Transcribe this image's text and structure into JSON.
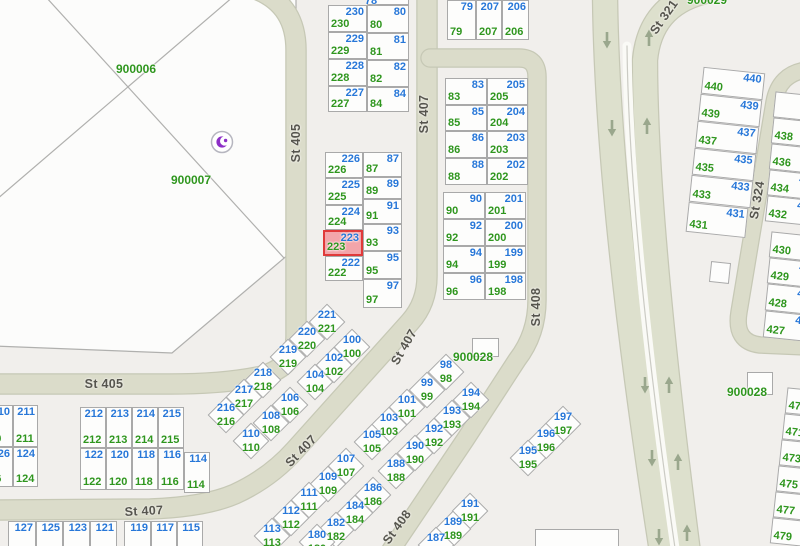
{
  "colors": {
    "background": "#f1efec",
    "parcel_fill": "#fdfdfc",
    "parcel_border": "#a9a9a9",
    "road_fill": "#dbdcca",
    "road_edge": "#c6c8b5",
    "arrow": "#9aa78d",
    "label_green": "#2f961e",
    "label_blue": "#2777d8",
    "highlight_fill": "#f3a5aa",
    "highlight_border": "#e03a3a",
    "street_label": "#56554e",
    "mosque_purple": "#8d2fc7"
  },
  "icons": {
    "mosque_icon": "crescent-and-star",
    "road_arrow_icon": "one-way-direction-arrow"
  },
  "selected_parcel": {
    "green_number": "223",
    "blue_number": "223"
  },
  "street_labels": [
    {
      "text": "St 405"
    },
    {
      "text": "St 405"
    },
    {
      "text": "St 407"
    },
    {
      "text": "St 407"
    },
    {
      "text": "St 407"
    },
    {
      "text": "St 407"
    },
    {
      "text": "St 408"
    },
    {
      "text": "St 408"
    },
    {
      "text": "St 321"
    },
    {
      "text": "St 324"
    }
  ],
  "area_labels": [
    {
      "text": "900006"
    },
    {
      "text": "900007"
    },
    {
      "text": "900028"
    },
    {
      "text": "900028"
    },
    {
      "text": "900029"
    }
  ],
  "stray_labels": [
    {
      "text": "78"
    }
  ],
  "cells": [
    {
      "x": 328,
      "y": 5,
      "w": 39,
      "h": 27,
      "g": "230",
      "b": "230"
    },
    {
      "x": 328,
      "y": 32,
      "w": 39,
      "h": 27,
      "g": "229",
      "b": "229"
    },
    {
      "x": 328,
      "y": 59,
      "w": 39,
      "h": 27,
      "g": "228",
      "b": "228"
    },
    {
      "x": 328,
      "y": 86,
      "w": 39,
      "h": 26,
      "g": "227",
      "b": "227"
    },
    {
      "x": 367,
      "y": -20,
      "w": 42,
      "h": 25
    },
    {
      "x": 367,
      "y": 5,
      "w": 42,
      "h": 28,
      "g": "80",
      "b": "80"
    },
    {
      "x": 367,
      "y": 33,
      "w": 42,
      "h": 27,
      "g": "81",
      "b": "81"
    },
    {
      "x": 367,
      "y": 60,
      "w": 42,
      "h": 27,
      "g": "82",
      "b": "82"
    },
    {
      "x": 367,
      "y": 87,
      "w": 42,
      "h": 25,
      "g": "84",
      "b": "84"
    },
    {
      "x": 447,
      "y": 0,
      "w": 29,
      "h": 40,
      "g": "79",
      "b": "79"
    },
    {
      "x": 476,
      "y": 0,
      "w": 26,
      "h": 40,
      "g": "207",
      "b": "207"
    },
    {
      "x": 502,
      "y": 0,
      "w": 27,
      "h": 40,
      "g": "206",
      "b": "206"
    },
    {
      "x": 325,
      "y": 152,
      "w": 38,
      "h": 26,
      "g": "226",
      "b": "226"
    },
    {
      "x": 325,
      "y": 178,
      "w": 38,
      "h": 27,
      "g": "225",
      "b": "225"
    },
    {
      "x": 325,
      "y": 205,
      "w": 38,
      "h": 25,
      "g": "224",
      "b": "224"
    },
    {
      "x": 323,
      "y": 230,
      "w": 40,
      "h": 26,
      "g": "223",
      "b": "223",
      "hl": 1
    },
    {
      "x": 325,
      "y": 256,
      "w": 38,
      "h": 25,
      "g": "222",
      "b": "222"
    },
    {
      "x": 363,
      "y": 152,
      "w": 39,
      "h": 25,
      "g": "87",
      "b": "87"
    },
    {
      "x": 363,
      "y": 177,
      "w": 39,
      "h": 22,
      "g": "89",
      "b": "89"
    },
    {
      "x": 363,
      "y": 199,
      "w": 39,
      "h": 25,
      "g": "91",
      "b": "91"
    },
    {
      "x": 363,
      "y": 224,
      "w": 39,
      "h": 27,
      "g": "93",
      "b": "93"
    },
    {
      "x": 363,
      "y": 251,
      "w": 39,
      "h": 28,
      "g": "95",
      "b": "95"
    },
    {
      "x": 363,
      "y": 279,
      "w": 39,
      "h": 29,
      "g": "97",
      "b": "97"
    },
    {
      "x": 445,
      "y": 78,
      "w": 42,
      "h": 27,
      "g": "83",
      "b": "83"
    },
    {
      "x": 445,
      "y": 105,
      "w": 42,
      "h": 26,
      "g": "85",
      "b": "85"
    },
    {
      "x": 445,
      "y": 131,
      "w": 42,
      "h": 27,
      "g": "86",
      "b": "86"
    },
    {
      "x": 445,
      "y": 158,
      "w": 42,
      "h": 27,
      "g": "88",
      "b": "88"
    },
    {
      "x": 487,
      "y": 78,
      "w": 41,
      "h": 27,
      "g": "205",
      "b": "205"
    },
    {
      "x": 487,
      "y": 105,
      "w": 41,
      "h": 26,
      "g": "204",
      "b": "204"
    },
    {
      "x": 487,
      "y": 131,
      "w": 41,
      "h": 27,
      "g": "203",
      "b": "203"
    },
    {
      "x": 487,
      "y": 158,
      "w": 41,
      "h": 27,
      "g": "202",
      "b": "202"
    },
    {
      "x": 443,
      "y": 192,
      "w": 42,
      "h": 27,
      "g": "90",
      "b": "90"
    },
    {
      "x": 443,
      "y": 219,
      "w": 42,
      "h": 27,
      "g": "92",
      "b": "92"
    },
    {
      "x": 443,
      "y": 246,
      "w": 42,
      "h": 27,
      "g": "94",
      "b": "94"
    },
    {
      "x": 443,
      "y": 273,
      "w": 42,
      "h": 27,
      "g": "96",
      "b": "96"
    },
    {
      "x": 485,
      "y": 192,
      "w": 41,
      "h": 27,
      "g": "201",
      "b": "201"
    },
    {
      "x": 485,
      "y": 219,
      "w": 41,
      "h": 27,
      "g": "200",
      "b": "200"
    },
    {
      "x": 485,
      "y": 246,
      "w": 41,
      "h": 27,
      "g": "199",
      "b": "199"
    },
    {
      "x": 485,
      "y": 273,
      "w": 41,
      "h": 27,
      "g": "198",
      "b": "198"
    },
    {
      "x": -20,
      "y": 405,
      "w": 33,
      "h": 42,
      "g": "210",
      "b": "210"
    },
    {
      "x": -20,
      "y": 447,
      "w": 33,
      "h": 40,
      "g": "126",
      "b": "126"
    },
    {
      "x": 13,
      "y": 405,
      "w": 25,
      "h": 42,
      "g": "211",
      "b": "211"
    },
    {
      "x": 13,
      "y": 447,
      "w": 25,
      "h": 40,
      "g": "124",
      "b": "124"
    },
    {
      "x": 80,
      "y": 407,
      "w": 26,
      "h": 41,
      "g": "212",
      "b": "212"
    },
    {
      "x": 106,
      "y": 407,
      "w": 26,
      "h": 41,
      "g": "213",
      "b": "213"
    },
    {
      "x": 132,
      "y": 407,
      "w": 26,
      "h": 41,
      "g": "214",
      "b": "214"
    },
    {
      "x": 158,
      "y": 407,
      "w": 26,
      "h": 41,
      "g": "215",
      "b": "215"
    },
    {
      "x": 80,
      "y": 448,
      "w": 26,
      "h": 42,
      "g": "122",
      "b": "122"
    },
    {
      "x": 106,
      "y": 448,
      "w": 26,
      "h": 42,
      "g": "120",
      "b": "120"
    },
    {
      "x": 132,
      "y": 448,
      "w": 26,
      "h": 42,
      "g": "118",
      "b": "118"
    },
    {
      "x": 158,
      "y": 448,
      "w": 26,
      "h": 42,
      "g": "116",
      "b": "116"
    },
    {
      "x": 184,
      "y": 452,
      "w": 26,
      "h": 41,
      "g": "114",
      "b": "114"
    },
    {
      "x": 8,
      "y": 521,
      "w": 28,
      "h": 30,
      "b": "127"
    },
    {
      "x": 36,
      "y": 521,
      "w": 27,
      "h": 30,
      "b": "125"
    },
    {
      "x": 63,
      "y": 521,
      "w": 27,
      "h": 30,
      "b": "123"
    },
    {
      "x": 90,
      "y": 521,
      "w": 27,
      "h": 30,
      "b": "121"
    },
    {
      "x": 124,
      "y": 521,
      "w": 27,
      "h": 30,
      "b": "119"
    },
    {
      "x": 151,
      "y": 521,
      "w": 26,
      "h": 30,
      "b": "117"
    },
    {
      "x": 177,
      "y": 521,
      "w": 26,
      "h": 30,
      "b": "115"
    },
    {
      "x": 702,
      "y": 70,
      "w": 62,
      "h": 27,
      "g": "440",
      "b": "440",
      "r": 6
    },
    {
      "x": 699,
      "y": 97,
      "w": 62,
      "h": 27,
      "g": "439",
      "b": "439",
      "r": 6
    },
    {
      "x": 696,
      "y": 124,
      "w": 62,
      "h": 27,
      "g": "437",
      "b": "437",
      "r": 6
    },
    {
      "x": 693,
      "y": 151,
      "w": 62,
      "h": 27,
      "g": "435",
      "b": "435",
      "r": 6
    },
    {
      "x": 690,
      "y": 178,
      "w": 62,
      "h": 27,
      "g": "433",
      "b": "433",
      "r": 6
    },
    {
      "x": 687,
      "y": 205,
      "w": 60,
      "h": 30,
      "g": "431",
      "b": "431",
      "r": 6
    },
    {
      "x": 774,
      "y": 94,
      "w": 52,
      "h": 26,
      "r": 6
    },
    {
      "x": 772,
      "y": 120,
      "w": 52,
      "h": 26,
      "g": "438",
      "b": "438",
      "r": 6
    },
    {
      "x": 770,
      "y": 146,
      "w": 52,
      "h": 26,
      "g": "436",
      "b": "436",
      "r": 6
    },
    {
      "x": 768,
      "y": 172,
      "w": 52,
      "h": 26,
      "g": "434",
      "b": "434",
      "r": 6
    },
    {
      "x": 766,
      "y": 198,
      "w": 52,
      "h": 26,
      "g": "432",
      "b": "432",
      "r": 6
    },
    {
      "x": 770,
      "y": 234,
      "w": 52,
      "h": 26,
      "g": "430",
      "b": "430",
      "r": 6
    },
    {
      "x": 768,
      "y": 260,
      "w": 52,
      "h": 26,
      "g": "429",
      "b": "429",
      "r": 6
    },
    {
      "x": 766,
      "y": 286,
      "w": 52,
      "h": 27,
      "g": "428",
      "b": "428",
      "r": 6
    },
    {
      "x": 764,
      "y": 313,
      "w": 52,
      "h": 27,
      "g": "427",
      "b": "427",
      "r": 6
    },
    {
      "x": 786,
      "y": 390,
      "w": 52,
      "h": 26,
      "g": "470",
      "b": "470",
      "r": 6
    },
    {
      "x": 783,
      "y": 416,
      "w": 52,
      "h": 26,
      "g": "471",
      "b": "471",
      "r": 6
    },
    {
      "x": 780,
      "y": 442,
      "w": 52,
      "h": 26,
      "g": "473",
      "b": "473",
      "r": 6
    },
    {
      "x": 777,
      "y": 468,
      "w": 52,
      "h": 26,
      "g": "475",
      "b": "475",
      "r": 6
    },
    {
      "x": 774,
      "y": 494,
      "w": 52,
      "h": 26,
      "g": "477",
      "b": "477",
      "r": 6
    },
    {
      "x": 771,
      "y": 520,
      "w": 52,
      "h": 26,
      "g": "479",
      "b": "479",
      "r": 6
    },
    {
      "x": 710,
      "y": 262,
      "w": 20,
      "h": 21,
      "r": 6
    },
    {
      "x": 472,
      "y": 338,
      "w": 27,
      "h": 19
    },
    {
      "x": 747,
      "y": 372,
      "w": 26,
      "h": 23
    },
    {
      "x": 535,
      "y": 529,
      "w": 84,
      "h": 30
    }
  ],
  "diamonds": [
    {
      "x": 327,
      "y": 322,
      "g": "221",
      "b": "221"
    },
    {
      "x": 307,
      "y": 339,
      "g": "220",
      "b": "220"
    },
    {
      "x": 288,
      "y": 357,
      "g": "219",
      "b": "219"
    },
    {
      "x": 263,
      "y": 380,
      "g": "218",
      "b": "218"
    },
    {
      "x": 244,
      "y": 397,
      "g": "217",
      "b": "217"
    },
    {
      "x": 226,
      "y": 415,
      "g": "216",
      "b": "216"
    },
    {
      "x": 352,
      "y": 347,
      "g": "100",
      "b": "100"
    },
    {
      "x": 334,
      "y": 365,
      "g": "102",
      "b": "102"
    },
    {
      "x": 315,
      "y": 382,
      "g": "104",
      "b": "104"
    },
    {
      "x": 290,
      "y": 405,
      "g": "106",
      "b": "106"
    },
    {
      "x": 271,
      "y": 423,
      "g": "108",
      "b": "108"
    },
    {
      "x": 251,
      "y": 441,
      "g": "110",
      "b": "110"
    },
    {
      "x": 446,
      "y": 372,
      "g": "98",
      "b": "98"
    },
    {
      "x": 427,
      "y": 390,
      "g": "99",
      "b": "99"
    },
    {
      "x": 407,
      "y": 407,
      "g": "101",
      "b": "101"
    },
    {
      "x": 389,
      "y": 425,
      "g": "103",
      "b": "103"
    },
    {
      "x": 372,
      "y": 442,
      "g": "105",
      "b": "105"
    },
    {
      "x": 471,
      "y": 400,
      "g": "194",
      "b": "194"
    },
    {
      "x": 452,
      "y": 418,
      "g": "193",
      "b": "193"
    },
    {
      "x": 434,
      "y": 436,
      "g": "192",
      "b": "192"
    },
    {
      "x": 415,
      "y": 453,
      "g": "190",
      "b": "190"
    },
    {
      "x": 396,
      "y": 471,
      "g": "188",
      "b": "188"
    },
    {
      "x": 346,
      "y": 466,
      "g": "107",
      "b": "107"
    },
    {
      "x": 328,
      "y": 484,
      "g": "109",
      "b": "109"
    },
    {
      "x": 309,
      "y": 500,
      "g": "111",
      "b": "111"
    },
    {
      "x": 291,
      "y": 518,
      "g": "112",
      "b": "112"
    },
    {
      "x": 272,
      "y": 536,
      "g": "113",
      "b": "113"
    },
    {
      "x": 373,
      "y": 495,
      "g": "186",
      "b": "186"
    },
    {
      "x": 355,
      "y": 513,
      "g": "184",
      "b": "184"
    },
    {
      "x": 336,
      "y": 530,
      "g": "182",
      "b": "182"
    },
    {
      "x": 317,
      "y": 542,
      "g": "180",
      "b": "180"
    },
    {
      "x": 470,
      "y": 511,
      "g": "191",
      "b": "191"
    },
    {
      "x": 453,
      "y": 529,
      "g": "189",
      "b": "189"
    },
    {
      "x": 436,
      "y": 545,
      "g": "187",
      "b": "187"
    },
    {
      "x": 563,
      "y": 424,
      "g": "197",
      "b": "197"
    },
    {
      "x": 546,
      "y": 441,
      "g": "196",
      "b": "196"
    },
    {
      "x": 528,
      "y": 458,
      "g": "195",
      "b": "195"
    }
  ],
  "road_arrows": [
    {
      "x": 607,
      "y": 40,
      "dir": 180
    },
    {
      "x": 612,
      "y": 128,
      "dir": 180
    },
    {
      "x": 645,
      "y": 385,
      "dir": 180
    },
    {
      "x": 652,
      "y": 458,
      "dir": 180
    },
    {
      "x": 659,
      "y": 537,
      "dir": 180
    },
    {
      "x": 649,
      "y": 38,
      "dir": 0
    },
    {
      "x": 647,
      "y": 126,
      "dir": 0
    },
    {
      "x": 669,
      "y": 385,
      "dir": 0
    },
    {
      "x": 678,
      "y": 462,
      "dir": 0
    },
    {
      "x": 687,
      "y": 533,
      "dir": 0
    }
  ]
}
